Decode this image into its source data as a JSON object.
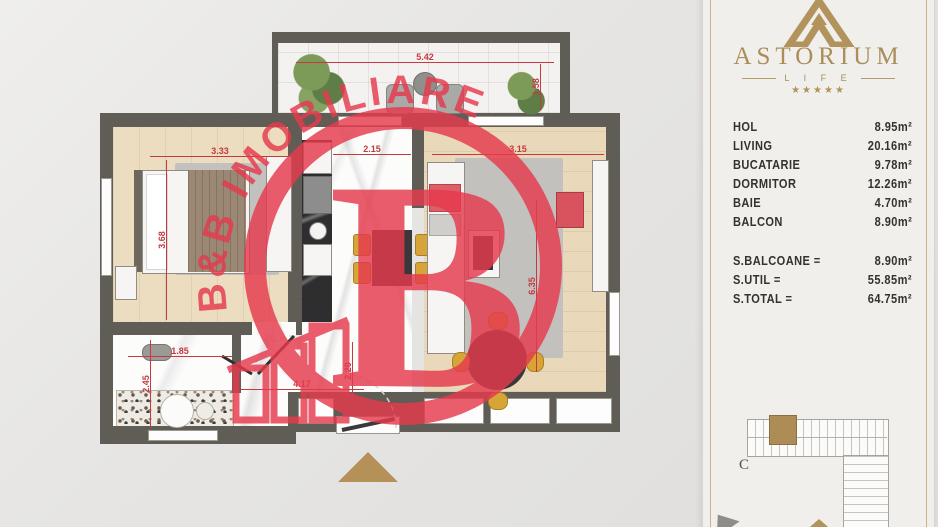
{
  "brand": {
    "name": "ASTORIUM",
    "subtitle": "L I F E",
    "stars": "★★★★★",
    "gold": "#b2935b"
  },
  "watermark": {
    "arc_text": "B&B IMOBILIARE",
    "big_letter": "B",
    "red": "#e63a4d"
  },
  "areas": {
    "rows": [
      {
        "label": "HOL",
        "value": "8.95m²"
      },
      {
        "label": "LIVING",
        "value": "20.16m²"
      },
      {
        "label": "BUCATARIE",
        "value": "9.78m²"
      },
      {
        "label": "DORMITOR",
        "value": "12.26m²"
      },
      {
        "label": "BAIE",
        "value": "4.70m²"
      },
      {
        "label": "BALCON",
        "value": "8.90m²"
      }
    ],
    "totals": [
      {
        "label": "S.BALCOANE =",
        "value": "8.90m²"
      },
      {
        "label": "S.UTIL =",
        "value": "55.85m²"
      },
      {
        "label": "S.TOTAL =",
        "value": "64.75m²"
      }
    ]
  },
  "minimap": {
    "block_label": "C"
  },
  "plan": {
    "dims": {
      "balcony_width": "5.42",
      "balcony_depth": "1.58",
      "bedroom_width": "3.33",
      "bedroom_depth": "3.68",
      "kitchen_width": "2.15",
      "living_width": "3.15",
      "living_depth": "6.35",
      "hall_width": "1.85",
      "bath_depth": "2.45",
      "hall_length": "4.17",
      "entry_depth": "2.20"
    },
    "dim_color": "#c43a40",
    "wall_color": "#5f5d55"
  }
}
